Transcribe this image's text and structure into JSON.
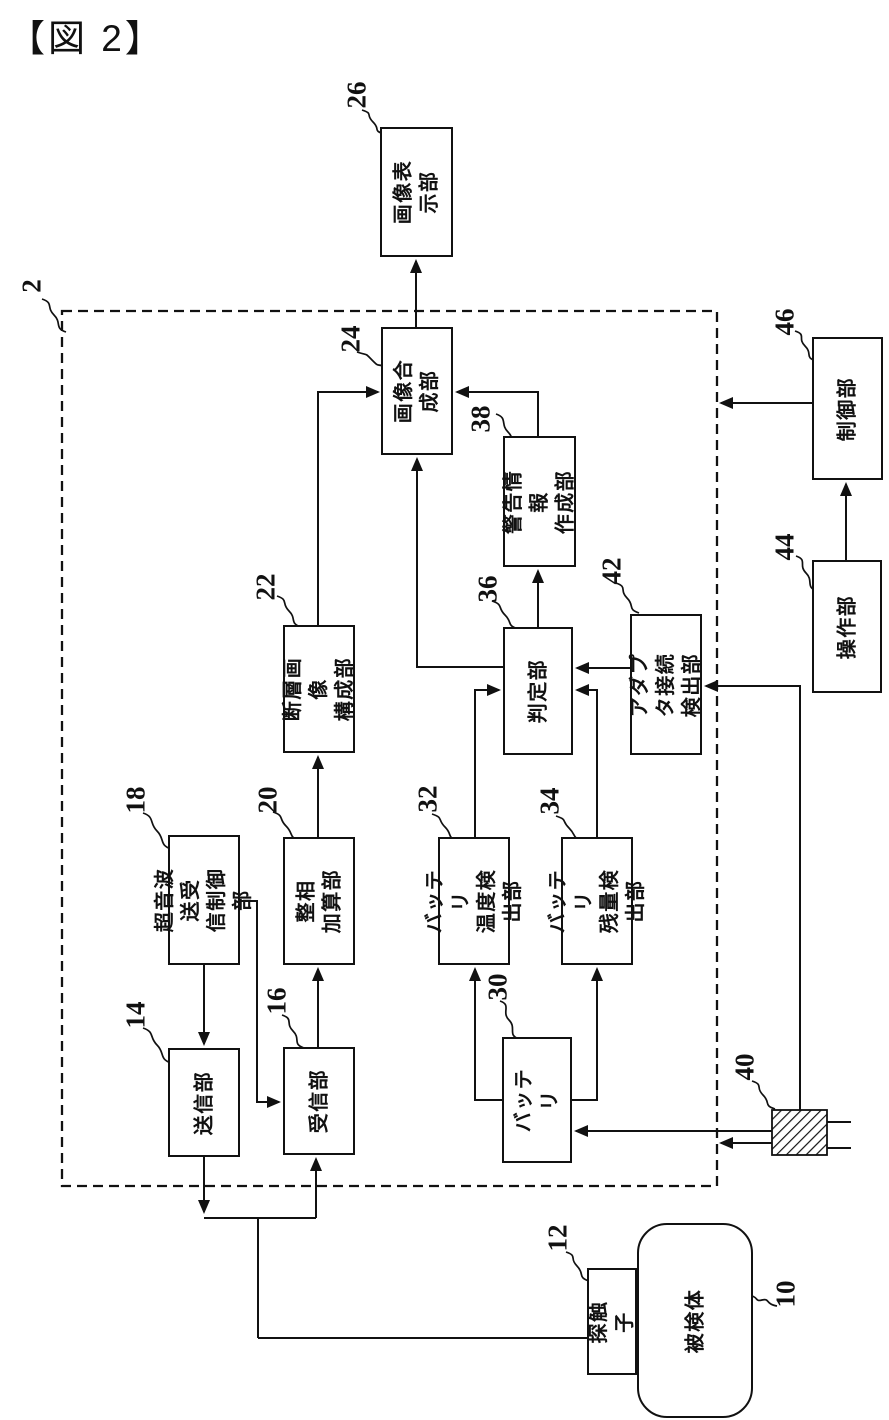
{
  "title": "【図 2】",
  "colors": {
    "ink": "#111111",
    "background": "#ffffff"
  },
  "diagram": {
    "device_ref": "2",
    "nodes": [
      {
        "ref": "26",
        "label": "画像表示部"
      },
      {
        "ref": "24",
        "label": "画像合成部"
      },
      {
        "ref": "38",
        "label": "警告情報\n作成部"
      },
      {
        "ref": "46",
        "label": "制御部"
      },
      {
        "ref": "44",
        "label": "操作部"
      },
      {
        "ref": "42",
        "label": "アダプタ接続\n検出部"
      },
      {
        "ref": "36",
        "label": "判定部"
      },
      {
        "ref": "22",
        "label": "断層画像\n構成部"
      },
      {
        "ref": "20",
        "label": "整相\n加算部"
      },
      {
        "ref": "18",
        "label": "超音波送受\n信制御部"
      },
      {
        "ref": "14",
        "label": "送信部"
      },
      {
        "ref": "16",
        "label": "受信部"
      },
      {
        "ref": "32",
        "label": "バッテリ\n温度検出部"
      },
      {
        "ref": "34",
        "label": "バッテリ\n残量検出部"
      },
      {
        "ref": "30",
        "label": "バッテリ"
      },
      {
        "ref": "12",
        "label": "探触子"
      },
      {
        "ref": "10",
        "label": "被検体"
      },
      {
        "ref": "40"
      }
    ]
  }
}
